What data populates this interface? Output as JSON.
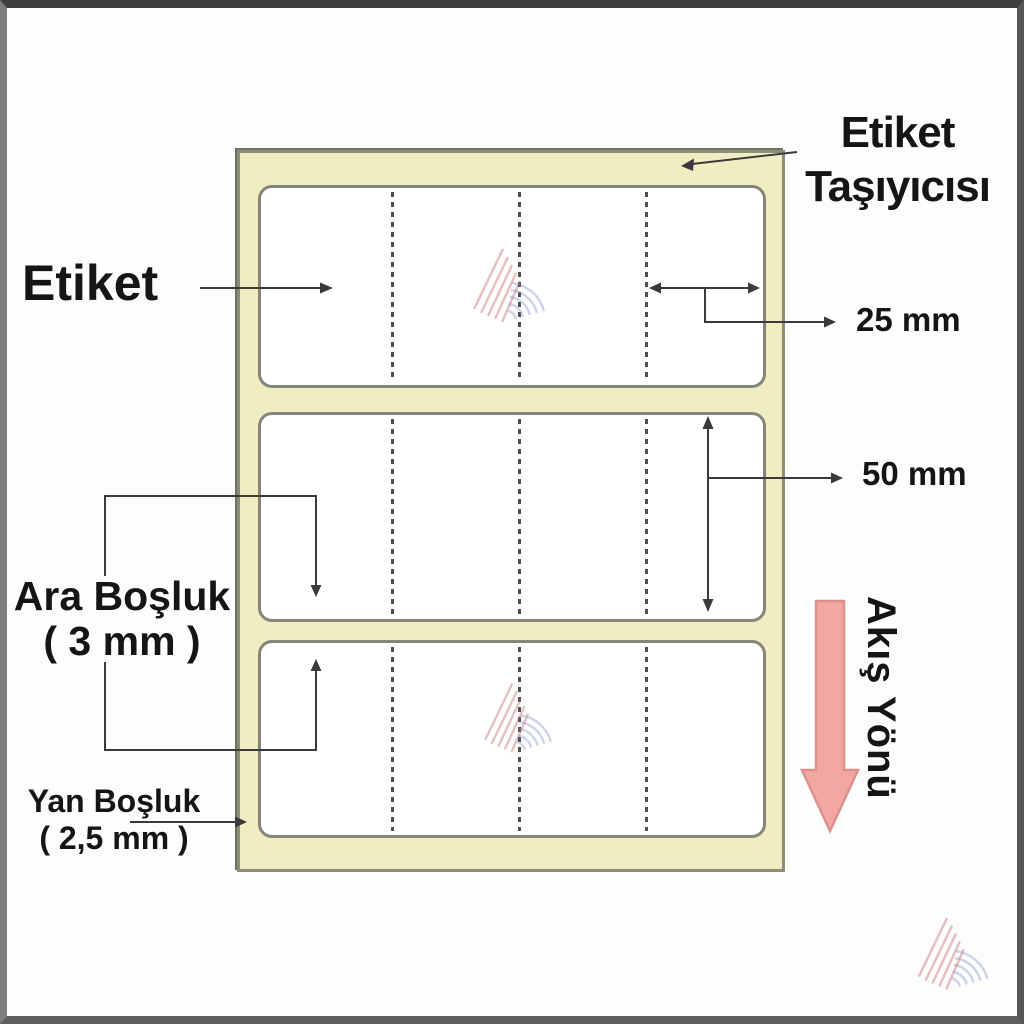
{
  "diagram": {
    "annotations": {
      "etiket": {
        "label": "Etiket"
      },
      "carrier": {
        "line1": "Etiket",
        "line2": "Taşıyıcısı"
      },
      "width_dim": {
        "label": "25 mm"
      },
      "height_dim": {
        "label": "50 mm"
      },
      "gap_dim": {
        "line1": "Ara Boşluk",
        "line2": "( 3 mm )"
      },
      "side_margin_dim": {
        "line1": "Yan Boşluk",
        "line2": "( 2,5 mm )"
      },
      "flow": {
        "label": "Akış Yönü"
      }
    },
    "structure": {
      "label_count": 3,
      "perforation_columns_per_label": 4
    },
    "colors": {
      "carrier_fill": "#f1edc3",
      "carrier_border": "#8d8d7a",
      "label_border": "#85857a",
      "annotation_line": "#3a3a3a",
      "flow_arrow_fill": "#f2a7a3",
      "flow_arrow_stroke": "#dd8f8c",
      "watermark_red": "#c05a5a",
      "watermark_blue": "#8090c5",
      "frame_gray": "#5e5e5e"
    }
  }
}
